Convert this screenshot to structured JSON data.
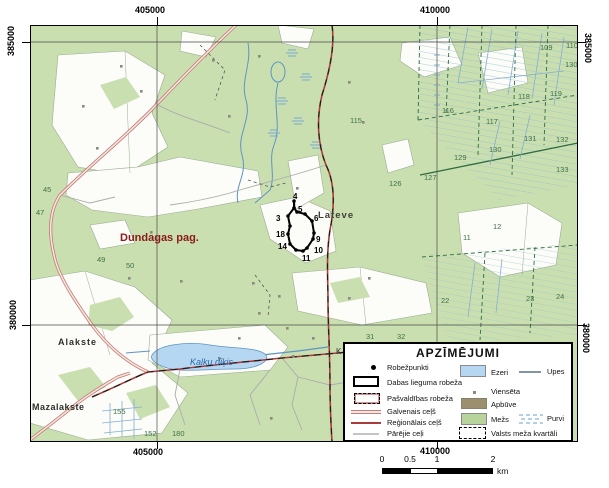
{
  "frame": {
    "grid_labels": {
      "top": [
        "405000",
        "410000"
      ],
      "bottom": [
        "405000",
        "410000"
      ],
      "left": [
        "385000",
        "380000"
      ],
      "right": [
        "385000",
        "380000"
      ]
    }
  },
  "map": {
    "labels": {
      "municipality": "Dundagas pag.",
      "settlement_lateve": "Lateve",
      "settlement_alakste": "Alakste",
      "settlement_mazalakste": "Mazalakste",
      "lake": "Kalku dīķis",
      "partial": "K"
    },
    "boundary_points": [
      "3",
      "4",
      "5",
      "6",
      "9",
      "10",
      "11",
      "14",
      "18"
    ],
    "quarter_numbers": [
      "45",
      "47",
      "49",
      "50",
      "109",
      "110",
      "130",
      "115",
      "116",
      "117",
      "118",
      "119",
      "126",
      "127",
      "129",
      "130",
      "131",
      "132",
      "133",
      "11",
      "12",
      "22",
      "23",
      "24",
      "31",
      "32",
      "155",
      "152",
      "180"
    ]
  },
  "legend": {
    "title": "APZĪMĒJUMI",
    "items": [
      {
        "symbol": "boundary-point",
        "label": "Robežpunkti"
      },
      {
        "symbol": "black-outline-rect",
        "label": "Dabas lieguma robeža"
      },
      {
        "symbol": "pink-dashed-rect",
        "label": "Pašvaldības robeža"
      },
      {
        "symbol": "pink-double-line",
        "label": "Galvenais ceļš"
      },
      {
        "symbol": "dark-red-line",
        "label": "Reģionālais ceļš"
      },
      {
        "symbol": "gray-line",
        "label": "Pārējie ceļi"
      },
      {
        "symbol": "blue-rect",
        "label": "Ezeri"
      },
      {
        "symbol": "gray-blue-line",
        "label": "Upes"
      },
      {
        "symbol": "small-gray-dot",
        "label": "Viensēta"
      },
      {
        "symbol": "brown-rect",
        "label": "Apbūve"
      },
      {
        "symbol": "green-rect",
        "label": "Mežs"
      },
      {
        "symbol": "swamp-dashes",
        "label": "Purvi"
      },
      {
        "symbol": "dashed-outline-rect",
        "label": "Valsts meža kvartāli"
      }
    ]
  },
  "scale_bar": {
    "tick_labels": [
      "0",
      "0.5",
      "1",
      "2"
    ],
    "unit": "km"
  },
  "colors": {
    "forest_green": "#cadfb0",
    "clearing_white": "#fcfcf9",
    "lake_blue": "#b5d7f2",
    "water_line": "#5f93c3",
    "main_road_pink": "#c97b7b",
    "regional_road_red": "#a83c3c",
    "reserve_boundary_black": "#000000",
    "municipality_label_red": "#8b1a1a",
    "quarter_number_green": "#3f7048",
    "built_up_brown": "#9b8f6e"
  }
}
